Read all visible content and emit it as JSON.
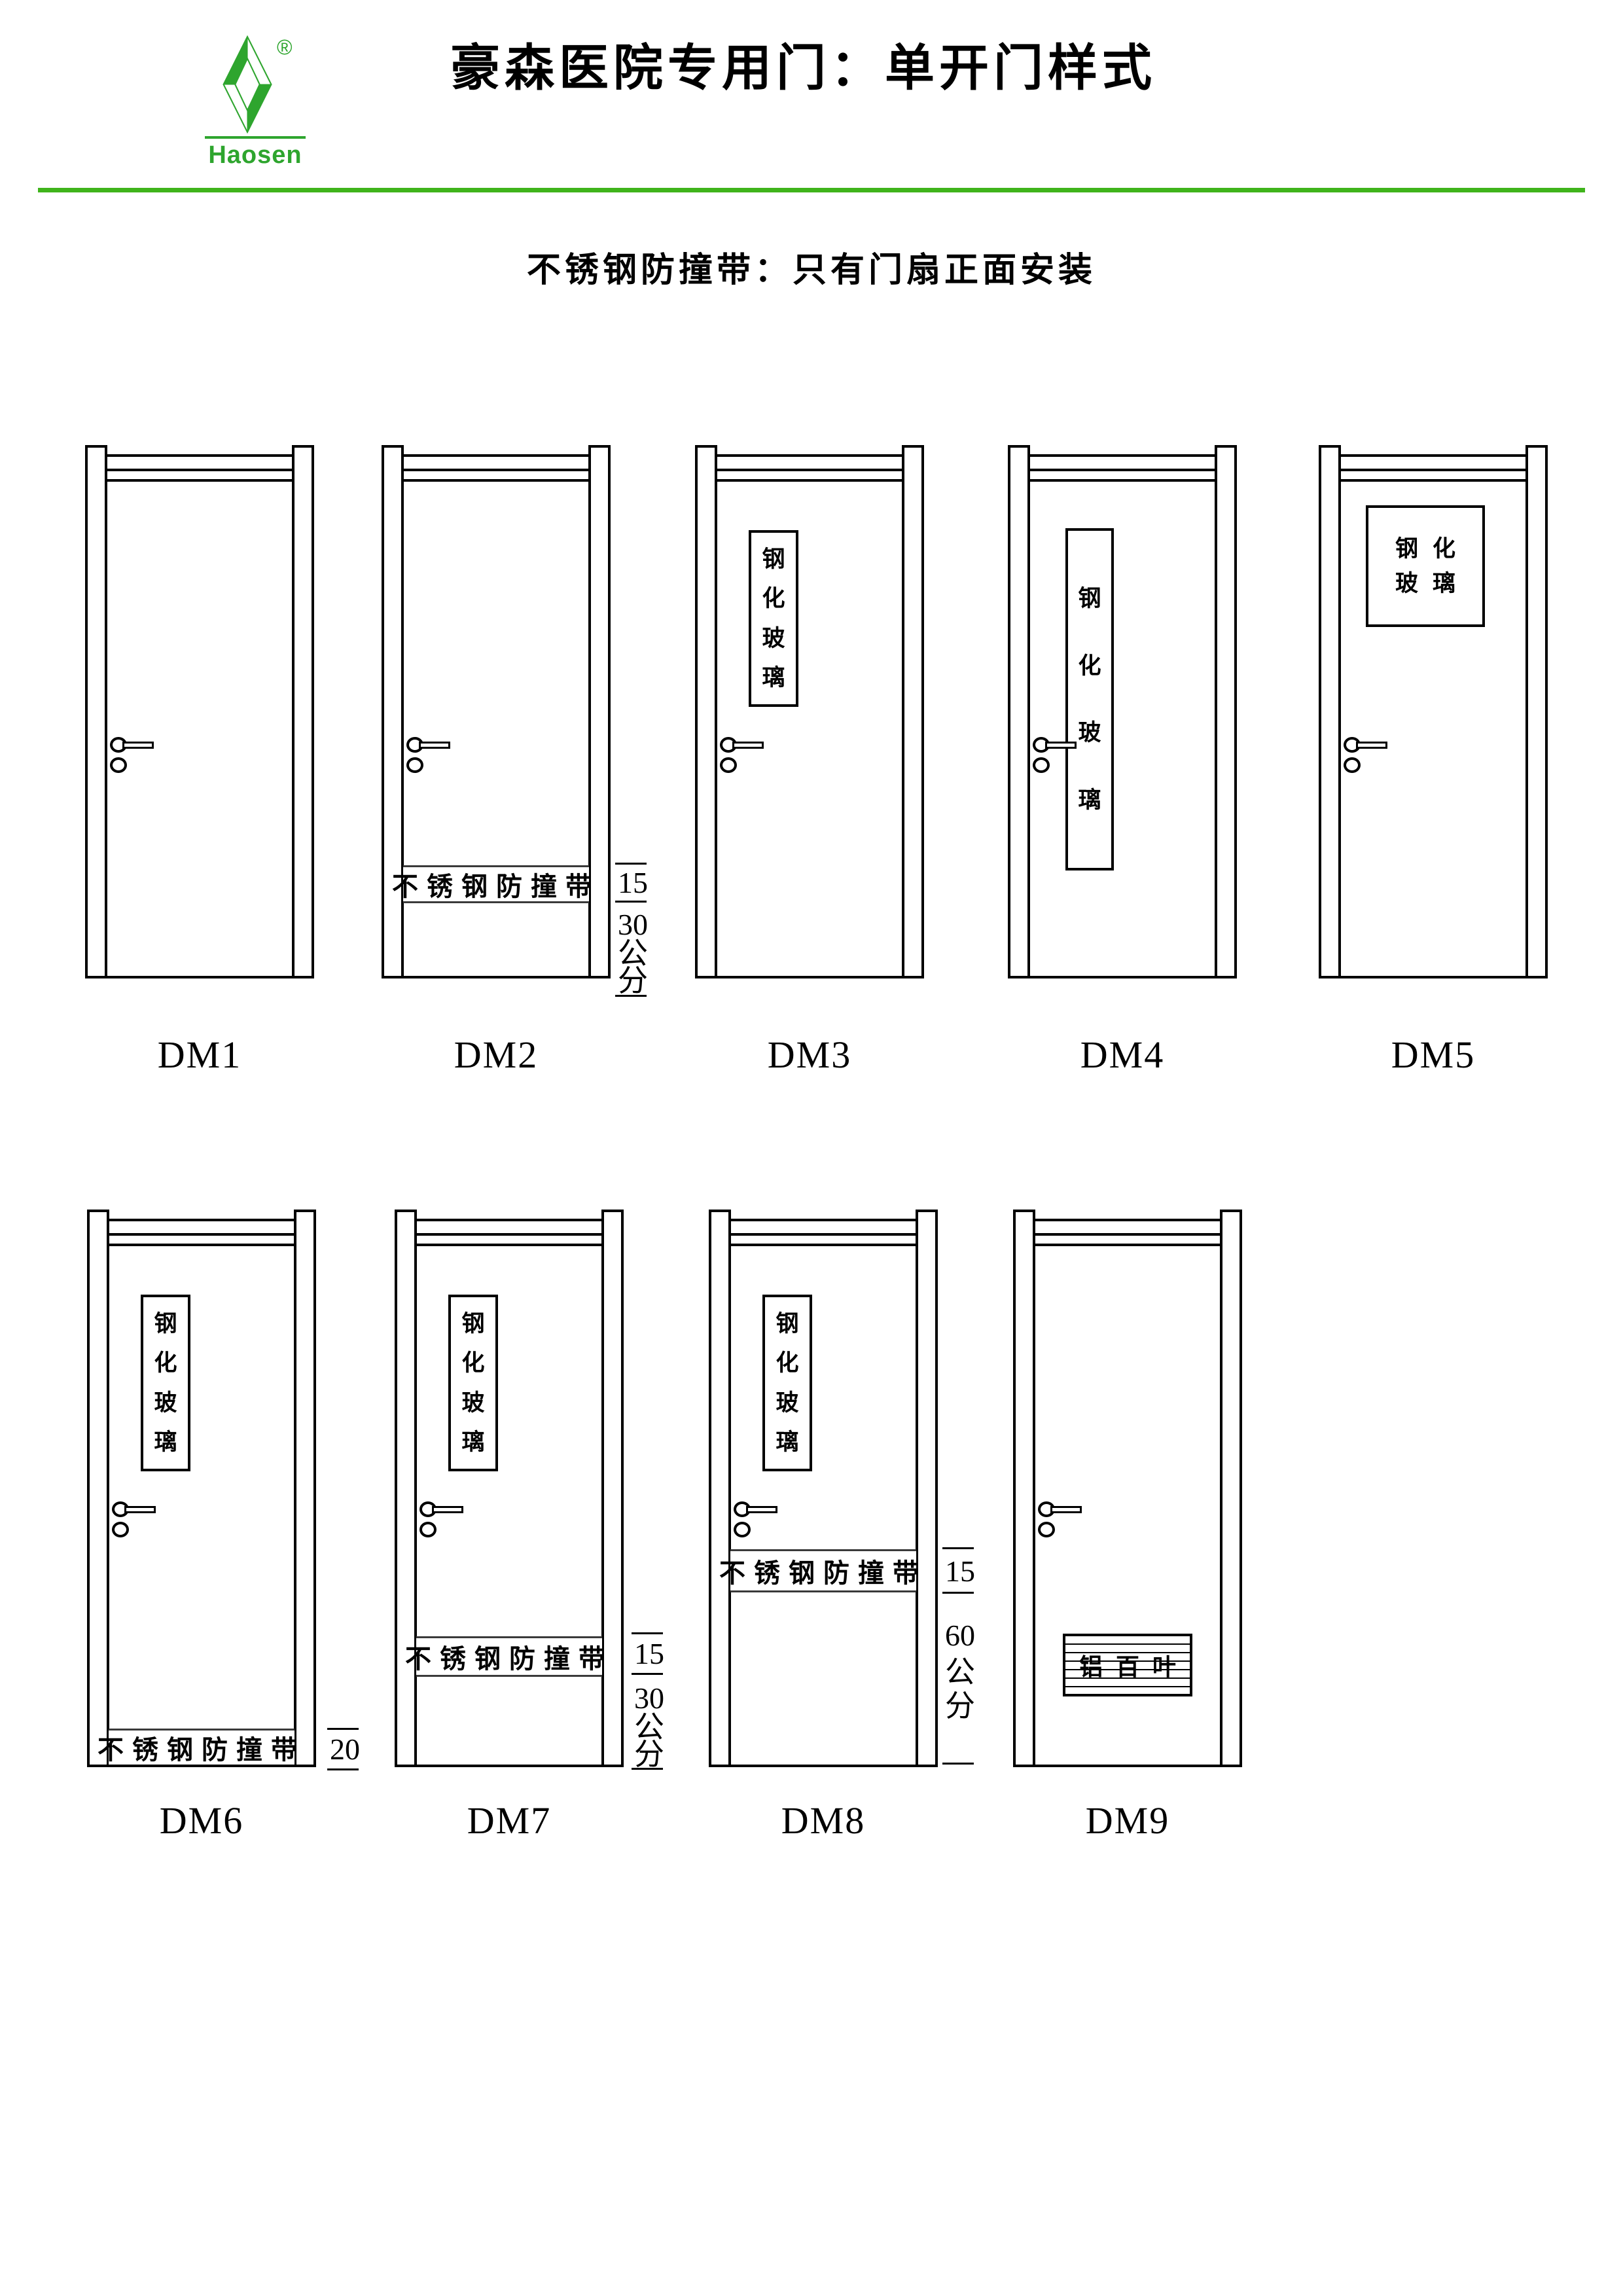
{
  "header": {
    "brand": "Haosen",
    "registered_mark": "®",
    "title": "豪森医院专用门：单开门样式",
    "subtitle": "不锈钢防撞带：只有门扇正面安装"
  },
  "colors": {
    "brand_green": "#2ea52e",
    "rule_green": "#3fb41b",
    "line_black": "#000000"
  },
  "door_names": [
    "DM1",
    "DM2",
    "DM3",
    "DM4",
    "DM5",
    "DM6",
    "DM7",
    "DM8",
    "DM9"
  ],
  "glass_label_chars": [
    "钢",
    "化",
    "玻",
    "璃"
  ],
  "glass_label_lines": [
    "钢化",
    "玻璃"
  ],
  "bumper_label": "不锈钢防撞带",
  "louver_label": "铝百叶",
  "dims": {
    "dm2": {
      "a": "15",
      "b": "30",
      "unit": [
        "公",
        "分"
      ]
    },
    "dm6": {
      "a": "20"
    },
    "dm7": {
      "a": "15",
      "b": "30",
      "unit": [
        "公",
        "分"
      ]
    },
    "dm8": {
      "a": "15",
      "b": "60",
      "unit": [
        "公",
        "分"
      ]
    }
  }
}
